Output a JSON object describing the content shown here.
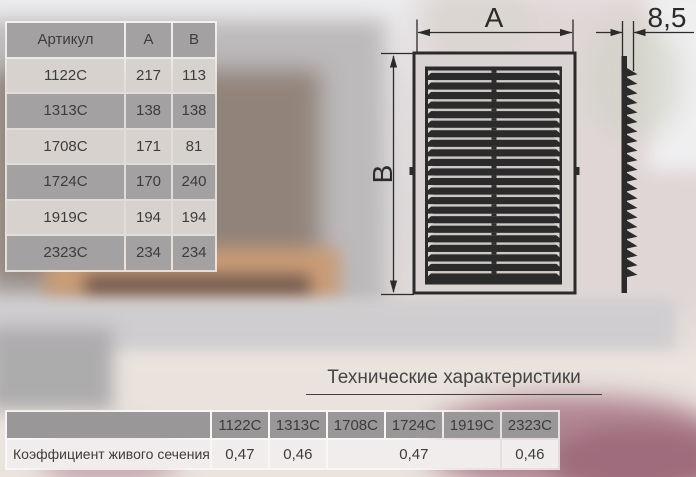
{
  "colors": {
    "cell_gray": "#a3a1a1",
    "cell_gray_bottom": "#999797",
    "row_light": "#d7d2ce",
    "row_light_bottom": "#f0edec",
    "text_dark": "#3d3d3d",
    "line_dark": "#2b2b2b",
    "panel_dark": "#2b2b2b",
    "slit_light": "#cfc9c5",
    "slit_bright": "#dcd6d2"
  },
  "spec_table": {
    "headers": [
      "Артикул",
      "А",
      "В"
    ],
    "rows": [
      [
        "1122С",
        "217",
        "113"
      ],
      [
        "1313С",
        "138",
        "138"
      ],
      [
        "1708С",
        "171",
        "81"
      ],
      [
        "1724С",
        "170",
        "240"
      ],
      [
        "1919С",
        "194",
        "194"
      ],
      [
        "2323С",
        "234",
        "234"
      ]
    ]
  },
  "drawing": {
    "width_label": "А",
    "height_label": "В",
    "depth_label": "8,5",
    "louver_count": 22,
    "tooth_count": 22
  },
  "tech": {
    "title": "Технические характеристики"
  },
  "coef_table": {
    "row_label": "Коэффициент живого сечения",
    "columns": [
      "1122С",
      "1313С",
      "1708С",
      "1724С",
      "1919С",
      "2323С"
    ],
    "values": [
      {
        "text": "0,47",
        "span": 1
      },
      {
        "text": "0,46",
        "span": 1
      },
      {
        "text": "0,47",
        "span": 3
      },
      {
        "text": "0,46",
        "span": 1
      }
    ]
  }
}
